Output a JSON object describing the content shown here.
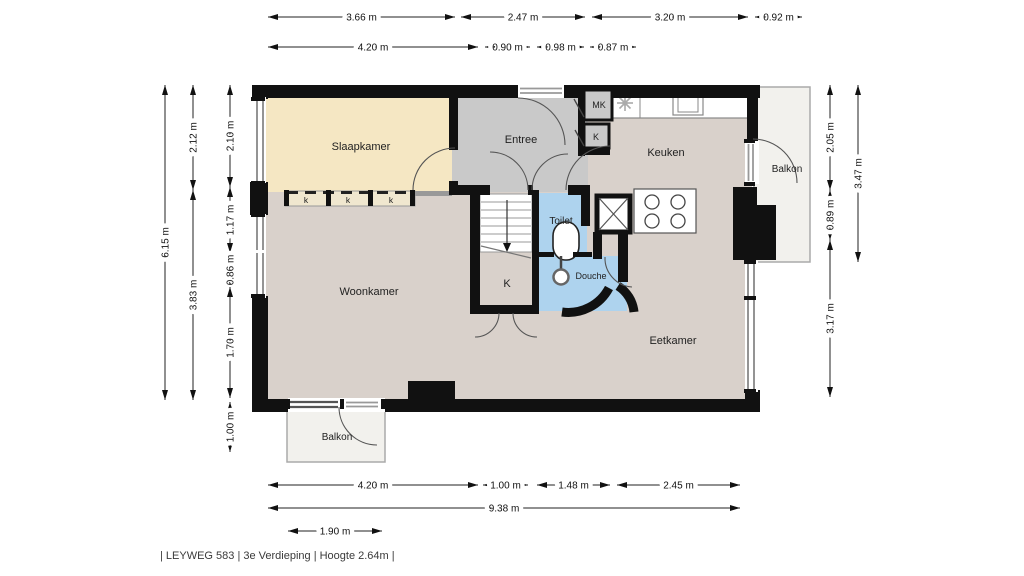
{
  "footer": {
    "text": "| LEYWEG 583 | 3e Verdieping | Hoogte 2.64m |"
  },
  "colors": {
    "wall": "#111111",
    "slaapkamer": "#f5e7c3",
    "entree": "#c9c9c9",
    "floor": "#d9d1cb",
    "sanitair": "#aed3ee",
    "balkon": "#f2f1ed",
    "kast": "#c9c9c9",
    "kast_strip": "#f0e7cf"
  },
  "rooms": {
    "slaapkamer": "Slaapkamer",
    "entree": "Entree",
    "keuken": "Keuken",
    "woonkamer": "Woonkamer",
    "eetkamer": "Eetkamer",
    "toilet": "Toilet",
    "douche": "Douche",
    "balkon_boven": "Balkon",
    "balkon_onder": "Balkon",
    "meterkast": "MK",
    "kast_klein": "K",
    "kast_trap": "K",
    "kast_1": "k",
    "kast_2": "k",
    "kast_3": "k"
  },
  "dimensions": [
    {
      "label": "3.66 m",
      "x1": 268,
      "y1": 17,
      "x2": 455,
      "y2": 17
    },
    {
      "label": "2.47 m",
      "x1": 461,
      "y1": 17,
      "x2": 585,
      "y2": 17
    },
    {
      "label": "3.20 m",
      "x1": 592,
      "y1": 17,
      "x2": 748,
      "y2": 17
    },
    {
      "label": "0.92 m",
      "x1": 755,
      "y1": 17,
      "x2": 802,
      "y2": 17
    },
    {
      "label": "4.20 m",
      "x1": 268,
      "y1": 47,
      "x2": 478,
      "y2": 47
    },
    {
      "label": "0.90 m",
      "x1": 485,
      "y1": 47,
      "x2": 530,
      "y2": 47
    },
    {
      "label": "0.98 m",
      "x1": 537,
      "y1": 47,
      "x2": 584,
      "y2": 47
    },
    {
      "label": "0.87 m",
      "x1": 590,
      "y1": 47,
      "x2": 636,
      "y2": 47
    },
    {
      "label": "6.15 m",
      "x1": 165,
      "y1": 85,
      "x2": 165,
      "y2": 400
    },
    {
      "label": "2.12 m",
      "x1": 193,
      "y1": 85,
      "x2": 193,
      "y2": 190
    },
    {
      "label": "3.83 m",
      "x1": 193,
      "y1": 190,
      "x2": 193,
      "y2": 400
    },
    {
      "label": "2.10 m",
      "x1": 230,
      "y1": 85,
      "x2": 230,
      "y2": 187
    },
    {
      "label": "1.17 m",
      "x1": 230,
      "y1": 187,
      "x2": 230,
      "y2": 253
    },
    {
      "label": "0.86 m",
      "x1": 230,
      "y1": 253,
      "x2": 230,
      "y2": 287
    },
    {
      "label": "1.70 m",
      "x1": 230,
      "y1": 287,
      "x2": 230,
      "y2": 398
    },
    {
      "label": "1.00 m",
      "x1": 230,
      "y1": 402,
      "x2": 230,
      "y2": 452
    },
    {
      "label": "2.05 m",
      "x1": 830,
      "y1": 85,
      "x2": 830,
      "y2": 190
    },
    {
      "label": "0.89 m",
      "x1": 830,
      "y1": 190,
      "x2": 830,
      "y2": 240
    },
    {
      "label": "3.17 m",
      "x1": 830,
      "y1": 240,
      "x2": 830,
      "y2": 397
    },
    {
      "label": "3.47 m",
      "x1": 858,
      "y1": 85,
      "x2": 858,
      "y2": 262
    },
    {
      "label": "4.20 m",
      "x1": 268,
      "y1": 485,
      "x2": 478,
      "y2": 485
    },
    {
      "label": "1.00 m",
      "x1": 483,
      "y1": 485,
      "x2": 528,
      "y2": 485
    },
    {
      "label": "1.48 m",
      "x1": 537,
      "y1": 485,
      "x2": 610,
      "y2": 485
    },
    {
      "label": "2.45 m",
      "x1": 617,
      "y1": 485,
      "x2": 740,
      "y2": 485
    },
    {
      "label": "9.38 m",
      "x1": 268,
      "y1": 508,
      "x2": 740,
      "y2": 508
    },
    {
      "label": "1.90 m",
      "x1": 288,
      "y1": 531,
      "x2": 382,
      "y2": 531
    }
  ]
}
